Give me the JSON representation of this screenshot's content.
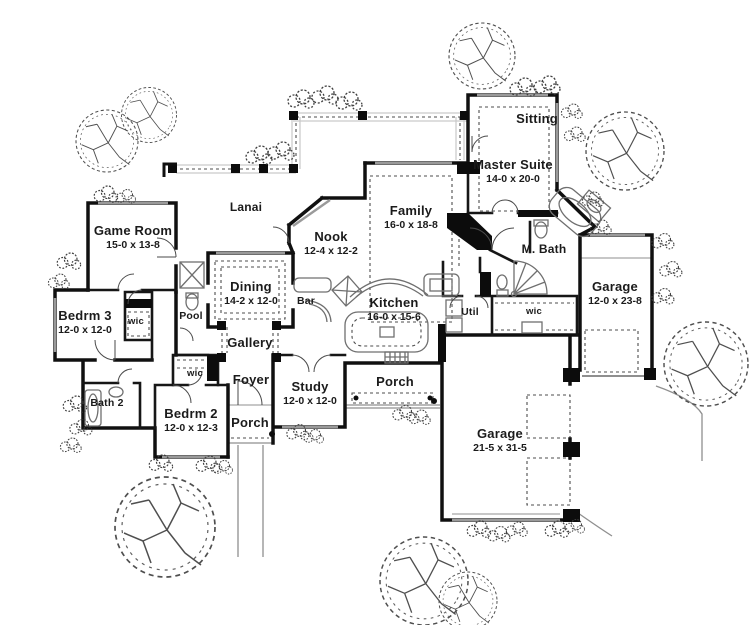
{
  "plan": {
    "drawing_title": "Single-story house floor plan",
    "colors": {
      "ink": "#141414",
      "detail_gray": "#8f8f8f",
      "dotted_gray": "#555555",
      "background": "#ffffff"
    },
    "rooms": [
      {
        "name": "Lanai",
        "dims": ""
      },
      {
        "name": "Game Room",
        "dims": "15-0 x 13-8"
      },
      {
        "name": "Nook",
        "dims": "12-4 x 12-2"
      },
      {
        "name": "Family",
        "dims": "16-0 x 18-8"
      },
      {
        "name": "Sitting",
        "dims": ""
      },
      {
        "name": "Master Suite",
        "dims": "14-0 x 20-0"
      },
      {
        "name": "M. Bath",
        "dims": ""
      },
      {
        "name": "Dining",
        "dims": "14-2 x 12-0"
      },
      {
        "name": "Bar",
        "dims": ""
      },
      {
        "name": "Pool",
        "dims": ""
      },
      {
        "name": "Bedrm 3",
        "dims": "12-0 x 12-0"
      },
      {
        "name": "wic",
        "dims": ""
      },
      {
        "name": "Kitchen",
        "dims": "16-0 x 15-6"
      },
      {
        "name": "Util",
        "dims": ""
      },
      {
        "name": "wic",
        "dims": ""
      },
      {
        "name": "Garage",
        "dims": "12-0 x 23-8"
      },
      {
        "name": "Gallery",
        "dims": ""
      },
      {
        "name": "Bath 2",
        "dims": ""
      },
      {
        "name": "wic",
        "dims": ""
      },
      {
        "name": "Foyer",
        "dims": ""
      },
      {
        "name": "Bedrm 2",
        "dims": "12-0 x 12-3"
      },
      {
        "name": "Porch",
        "dims": ""
      },
      {
        "name": "Study",
        "dims": "12-0 x 12-0"
      },
      {
        "name": "Porch",
        "dims": ""
      },
      {
        "name": "Garage",
        "dims": "21-5 x 31-5"
      }
    ]
  }
}
